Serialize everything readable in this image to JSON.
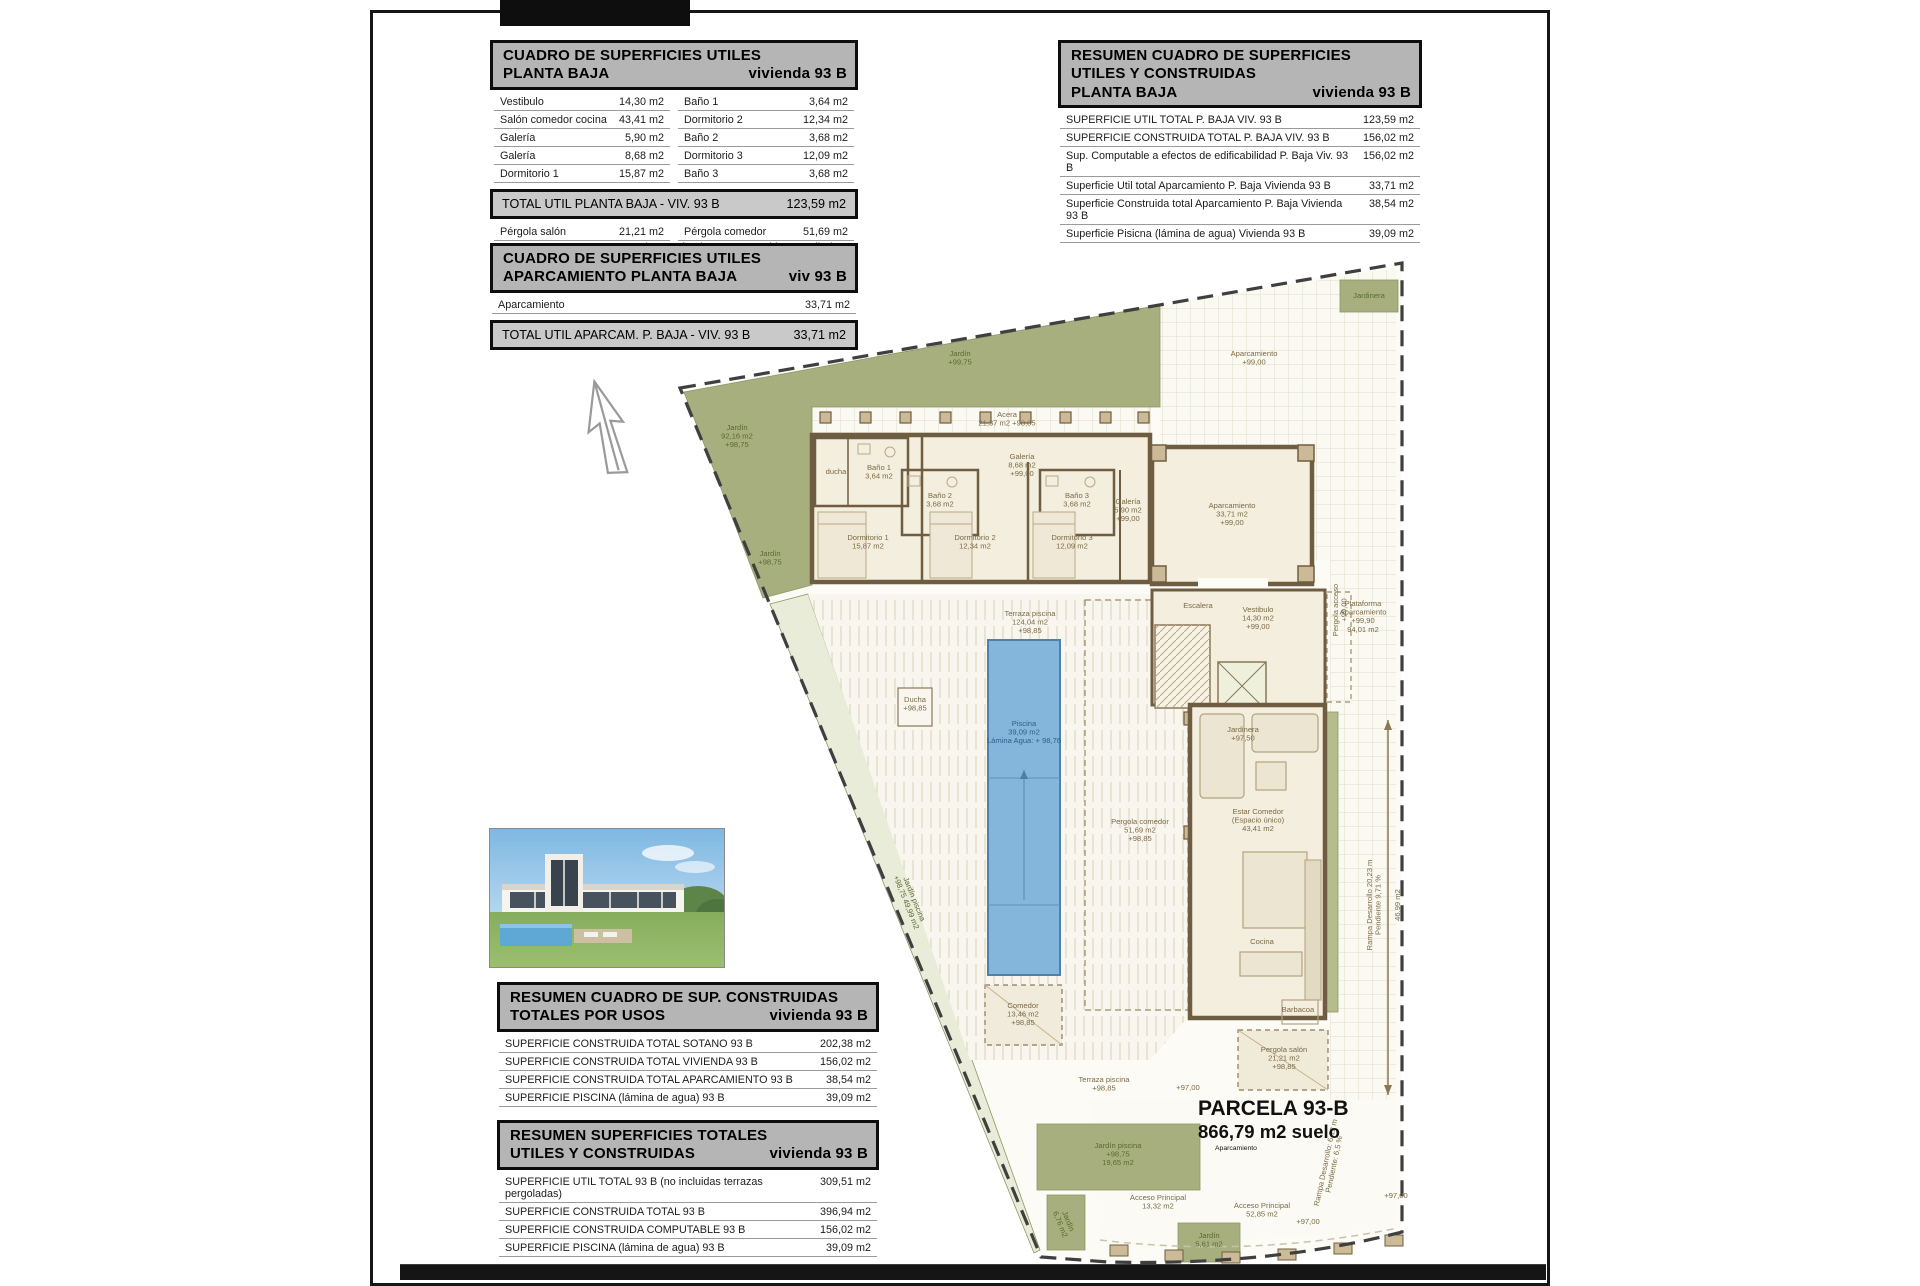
{
  "colors": {
    "paper": "#ffffff",
    "table_header_bg": "#b5b5b5",
    "table_total_bg": "#c9c9c9",
    "garden_green": "#a6af7d",
    "pool_blue": "#84b6db",
    "wall_brown": "#6f5d41",
    "ink": "#111111"
  },
  "tables": {
    "tableA": {
      "header": [
        [
          "CUADRO DE SUPERFICIES UTILES",
          ""
        ],
        [
          "PLANTA BAJA",
          "vivienda 93 B"
        ]
      ],
      "sections": [
        {
          "type": "rows",
          "rows": [
            [
              "Vestibulo",
              "14,30 m2",
              "Baño 1",
              "3,64 m2"
            ],
            [
              "Salón comedor cocina",
              "43,41 m2",
              "Dormitorio 2",
              "12,34 m2"
            ],
            [
              "Galería",
              "5,90 m2",
              "Baño 2",
              "3,68 m2"
            ],
            [
              "Galería",
              "8,68 m2",
              "Dormitorio 3",
              "12,09 m2"
            ],
            [
              "Dormitorio 1",
              "15,87 m2",
              "Baño 3",
              "3,68 m2"
            ]
          ]
        },
        {
          "type": "total",
          "label": "TOTAL UTIL PLANTA BAJA - VIV.  93 B",
          "value": "123,59 m2"
        },
        {
          "type": "rows",
          "rows": [
            [
              "Pérgola salón",
              "21,21 m2",
              "Pérgola comedor",
              "51,69 m2"
            ],
            [
              "Pérgola acceso",
              "7,54 m2",
              "(Nota: pérgolas no computables en Utiles)",
              ""
            ]
          ]
        }
      ]
    },
    "tableB": {
      "header": [
        [
          "CUADRO DE SUPERFICIES UTILES",
          ""
        ],
        [
          "APARCAMIENTO PLANTA BAJA",
          "viv 93 B"
        ]
      ],
      "sections": [
        {
          "type": "rows",
          "rows": [
            [
              "Aparcamiento",
              "33,71 m2"
            ]
          ]
        },
        {
          "type": "total",
          "label": "TOTAL UTIL APARCAM.  P. BAJA - VIV.  93 B",
          "value": "33,71 m2"
        }
      ]
    },
    "tableC": {
      "header": [
        [
          "RESUMEN CUADRO DE SUPERFICIES",
          ""
        ],
        [
          "UTILES Y CONSTRUIDAS",
          ""
        ],
        [
          "PLANTA BAJA",
          "vivienda 93 B"
        ]
      ],
      "sections": [
        {
          "type": "rows",
          "rows": [
            [
              "SUPERFICIE UTIL TOTAL P. BAJA VIV. 93 B",
              "123,59 m2"
            ],
            [
              "SUPERFICIE CONSTRUIDA TOTAL P. BAJA VIV. 93 B",
              "156,02 m2"
            ],
            [
              "Sup. Computable a efectos de edificabilidad P. Baja Viv. 93 B",
              "156,02 m2"
            ],
            [
              "Superficie Util total Aparcamiento P. Baja Vivienda 93 B",
              "33,71 m2"
            ],
            [
              "Superficie Construida total Aparcamiento P. Baja Vivienda 93 B",
              "38,54 m2"
            ],
            [
              "Superficie Pisicna (lámina de agua) Vivienda 93 B",
              "39,09 m2"
            ]
          ]
        }
      ]
    },
    "tableD": {
      "header": [
        [
          "RESUMEN CUADRO DE SUP. CONSTRUIDAS",
          ""
        ],
        [
          "TOTALES POR USOS",
          "vivienda 93 B"
        ]
      ],
      "sections": [
        {
          "type": "rows",
          "rows": [
            [
              "SUPERFICIE CONSTRUIDA TOTAL  SOTANO  93 B",
              "202,38 m2"
            ],
            [
              "SUPERFICIE CONSTRUIDA TOTAL VIVIENDA 93 B",
              "156,02 m2"
            ],
            [
              "SUPERFICIE CONSTRUIDA TOTAL APARCAMIENTO  93 B",
              "38,54 m2"
            ],
            [
              "SUPERFICIE PISCINA (lámina de agua)  93 B",
              "39,09 m2"
            ]
          ]
        }
      ]
    },
    "tableE": {
      "header": [
        [
          "RESUMEN SUPERFICIES TOTALES",
          ""
        ],
        [
          "UTILES Y CONSTRUIDAS",
          "vivienda 93 B"
        ]
      ],
      "sections": [
        {
          "type": "rows",
          "rows": [
            [
              "SUPERFICIE UTIL TOTAL  93 B (no incluidas terrazas pergoladas)",
              "309,51 m2"
            ],
            [
              "SUPERFICIE CONSTRUIDA TOTAL  93 B",
              "396,94 m2"
            ],
            [
              "SUPERFICIE CONSTRUIDA COMPUTABLE  93 B",
              "156,02 m2"
            ],
            [
              "SUPERFICIE PISCINA (lámina de agua)  93 B",
              "39,09 m2"
            ]
          ]
        }
      ]
    }
  },
  "plan": {
    "parcela": {
      "title": "PARCELA  93-B",
      "area": "866,79 m2 suelo",
      "sub": "Aparcamiento"
    },
    "labels": [
      {
        "x": 960,
        "y": 356,
        "cls": "g",
        "lines": [
          "Jardín",
          "+99,75"
        ]
      },
      {
        "x": 737,
        "y": 430,
        "cls": "g",
        "lines": [
          "Jardín",
          "92,16 m2",
          "+98,75"
        ]
      },
      {
        "x": 770,
        "y": 556,
        "cls": "g",
        "lines": [
          "Jardín",
          "+98,75"
        ]
      },
      {
        "x": 912,
        "y": 900,
        "cls": "g",
        "rot": 68,
        "lines": [
          "Jardín piscina",
          "+98,75   49,99 m2"
        ]
      },
      {
        "x": 1118,
        "y": 1148,
        "cls": "g",
        "lines": [
          "Jardín piscina",
          "+98,75",
          "19,65 m2"
        ]
      },
      {
        "x": 1066,
        "y": 1222,
        "cls": "g",
        "rot": 68,
        "lines": [
          "Jardín",
          "6,76 m2"
        ]
      },
      {
        "x": 1209,
        "y": 1238,
        "cls": "g",
        "lines": [
          "Jardín",
          "5,61 m2"
        ]
      },
      {
        "x": 1369,
        "y": 298,
        "cls": "g",
        "lines": [
          "Jardinera"
        ]
      },
      {
        "x": 1254,
        "y": 356,
        "cls": "r",
        "lines": [
          "Aparcamiento",
          "+99,00"
        ]
      },
      {
        "x": 1007,
        "y": 417,
        "cls": "r",
        "lines": [
          "Acera",
          "21,37 m2  +98,85"
        ]
      },
      {
        "x": 1022,
        "y": 459,
        "cls": "r",
        "lines": [
          "Galería",
          "8,68 m2",
          "+99,00"
        ]
      },
      {
        "x": 1128,
        "y": 504,
        "cls": "r",
        "lines": [
          "Galería",
          "5,90 m2",
          "+99,00"
        ]
      },
      {
        "x": 836,
        "y": 474,
        "cls": "r",
        "lines": [
          "ducha"
        ]
      },
      {
        "x": 879,
        "y": 470,
        "cls": "r",
        "lines": [
          "Baño 1",
          "3,64 m2"
        ]
      },
      {
        "x": 940,
        "y": 498,
        "cls": "r",
        "lines": [
          "Baño 2",
          "3,68 m2"
        ]
      },
      {
        "x": 1077,
        "y": 498,
        "cls": "r",
        "lines": [
          "Baño 3",
          "3,68 m2"
        ]
      },
      {
        "x": 868,
        "y": 540,
        "cls": "r",
        "lines": [
          "Dormitorio 1",
          "15,87 m2"
        ]
      },
      {
        "x": 975,
        "y": 540,
        "cls": "r",
        "lines": [
          "Dormitorio 2",
          "12,34 m2"
        ]
      },
      {
        "x": 1072,
        "y": 540,
        "cls": "r",
        "lines": [
          "Dormitorio 3",
          "12,09 m2"
        ]
      },
      {
        "x": 1232,
        "y": 508,
        "cls": "r",
        "lines": [
          "Aparcamiento",
          "33,71 m2",
          "+99,00"
        ]
      },
      {
        "x": 1363,
        "y": 606,
        "cls": "r",
        "lines": [
          "Plataforma",
          "Aparcamiento",
          "+99,90",
          "94,01 m2"
        ]
      },
      {
        "x": 1198,
        "y": 608,
        "cls": "r",
        "lines": [
          "Escalera"
        ]
      },
      {
        "x": 1258,
        "y": 612,
        "cls": "r",
        "lines": [
          "Vestibulo",
          "14,30 m2",
          "+99,00"
        ]
      },
      {
        "x": 1338,
        "y": 610,
        "cls": "r",
        "rot": -90,
        "lines": [
          "Pergola acceso",
          "+99,00"
        ]
      },
      {
        "x": 1243,
        "y": 732,
        "cls": "r",
        "lines": [
          "Jardinera",
          "+97,50"
        ]
      },
      {
        "x": 1030,
        "y": 616,
        "cls": "r",
        "lines": [
          "Terraza piscina",
          "124,04 m2",
          "+98,85"
        ]
      },
      {
        "x": 1024,
        "y": 726,
        "cls": "b",
        "lines": [
          "Piscina",
          "39,09 m2",
          "Lámina Agua: + 98,76"
        ]
      },
      {
        "x": 1140,
        "y": 824,
        "cls": "r",
        "lines": [
          "Pergola comedor",
          "51,69 m2",
          "+98,85"
        ]
      },
      {
        "x": 1258,
        "y": 814,
        "cls": "r",
        "lines": [
          "Estar Comedor",
          "(Espacio único)",
          "43,41 m2"
        ]
      },
      {
        "x": 1262,
        "y": 944,
        "cls": "r",
        "lines": [
          "Cocina"
        ]
      },
      {
        "x": 1298,
        "y": 1012,
        "cls": "r",
        "lines": [
          "Barbacoa"
        ]
      },
      {
        "x": 1284,
        "y": 1052,
        "cls": "r",
        "lines": [
          "Pergola salón",
          "21,21 m2",
          "+98,85"
        ]
      },
      {
        "x": 1104,
        "y": 1082,
        "cls": "r",
        "lines": [
          "Terraza piscina",
          "+98,85"
        ]
      },
      {
        "x": 1023,
        "y": 1008,
        "cls": "r",
        "lines": [
          "Comedor",
          "13,46 m2",
          "+98,85"
        ]
      },
      {
        "x": 1158,
        "y": 1200,
        "cls": "r",
        "lines": [
          "Acceso Principal",
          "13,32 m2"
        ]
      },
      {
        "x": 1262,
        "y": 1208,
        "cls": "r",
        "lines": [
          "Acceso Principal",
          "52,85 m2"
        ]
      },
      {
        "x": 1372,
        "y": 905,
        "cls": "r",
        "rot": -90,
        "lines": [
          "Rampa Desarrollo 20,23 m",
          "Pendiente 9,71 %"
        ]
      },
      {
        "x": 1400,
        "y": 905,
        "cls": "r",
        "rot": -90,
        "lines": [
          "46,99 m2"
        ]
      },
      {
        "x": 1328,
        "y": 1163,
        "cls": "r",
        "rot": -78,
        "lines": [
          "Rampa Desarrollo: 6,12 m",
          "Pendiente: 6,5 %"
        ]
      },
      {
        "x": 1396,
        "y": 1198,
        "cls": "r",
        "lines": [
          "+97,00"
        ]
      },
      {
        "x": 1308,
        "y": 1224,
        "cls": "r",
        "lines": [
          "+97,00"
        ]
      },
      {
        "x": 1188,
        "y": 1090,
        "cls": "r",
        "lines": [
          "+97,00"
        ]
      },
      {
        "x": 915,
        "y": 702,
        "cls": "r",
        "lines": [
          "Ducha",
          "+98,85"
        ]
      }
    ]
  }
}
